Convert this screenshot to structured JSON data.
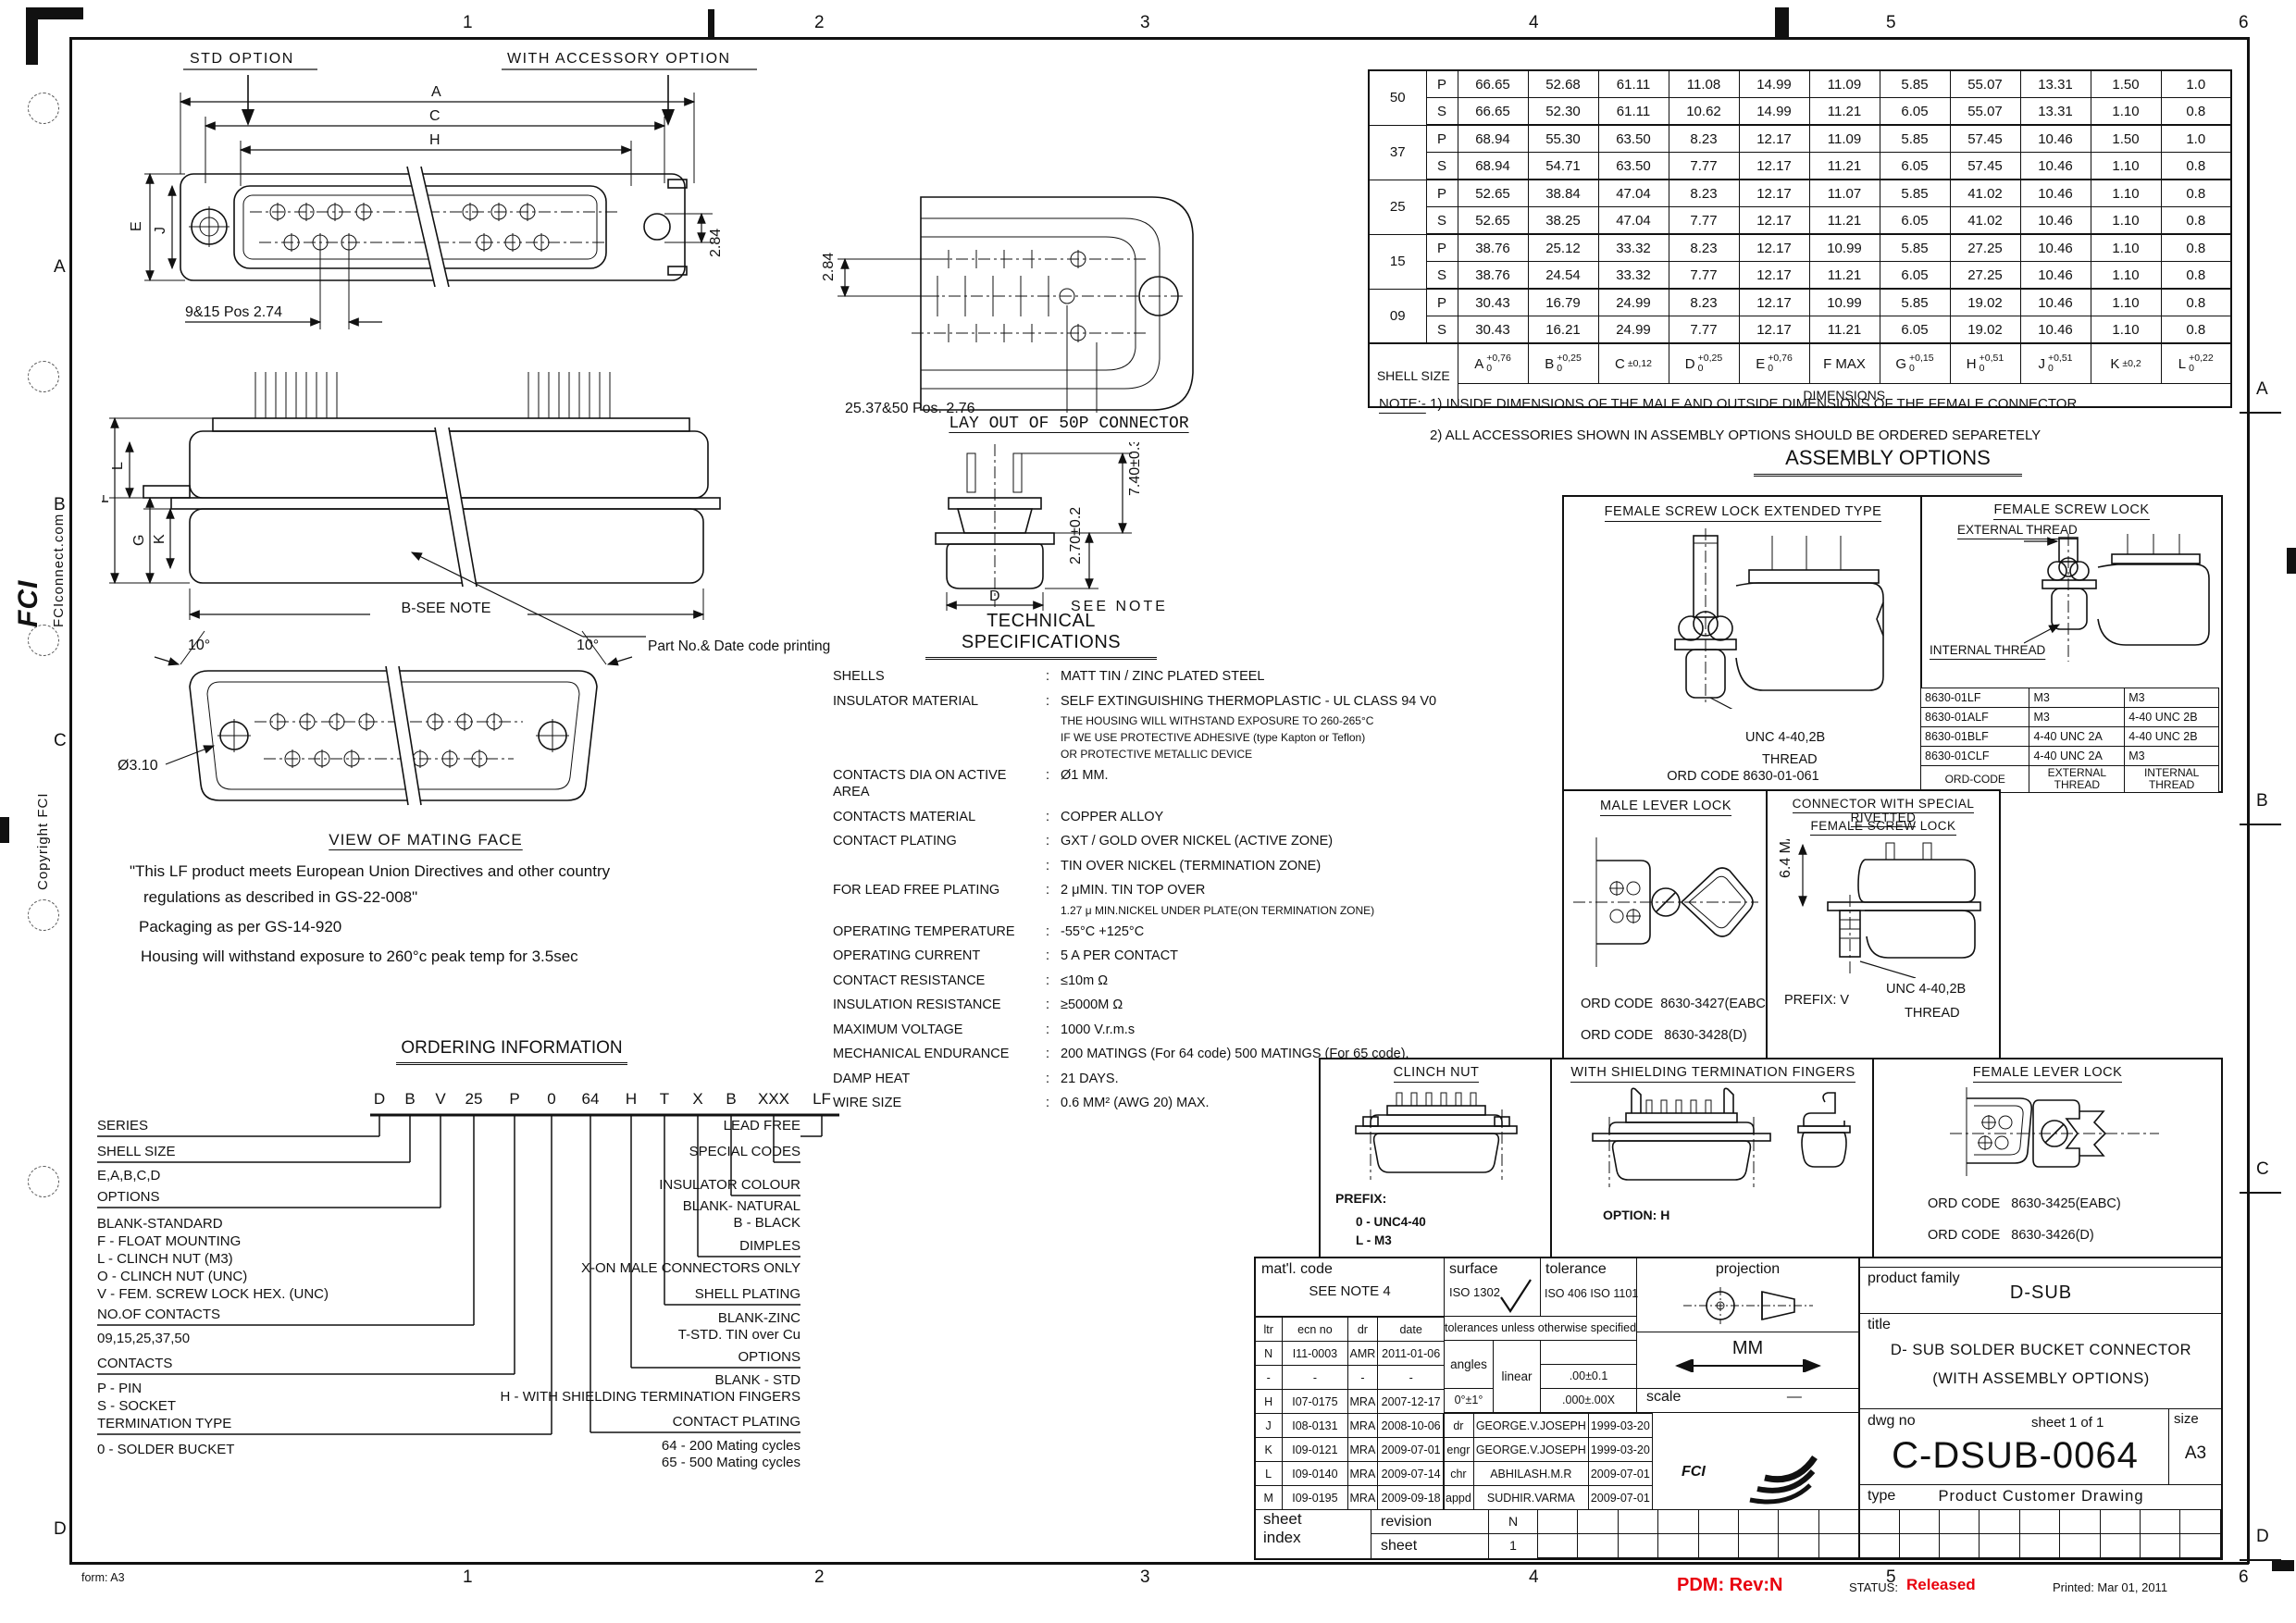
{
  "page": {
    "zones_h": [
      "1",
      "2",
      "3",
      "4",
      "5",
      "6"
    ],
    "zones_v": [
      "A",
      "B",
      "C",
      "D"
    ],
    "form": "form: A3",
    "pdm": "PDM: Rev:N",
    "status_label": "STATUS:",
    "status_value": "Released",
    "printed": "Printed: Mar 01, 2011",
    "site": "FCIconnect.com",
    "copyright": "Copyright FCI",
    "logo": "FCI",
    "accent_red": "#e8000d"
  },
  "dim_table": {
    "shell_size_label": "SHELL SIZE",
    "dimensions_label": "DIMENSIONS",
    "cols": [
      {
        "l": "A",
        "t": "+0,76",
        "b": "0"
      },
      {
        "l": "B",
        "t": "+0,25",
        "b": "0"
      },
      {
        "l": "C",
        "t": "±0,12",
        "b": ""
      },
      {
        "l": "D",
        "t": "+0,25",
        "b": "0"
      },
      {
        "l": "E",
        "t": "+0,76",
        "b": "0"
      },
      {
        "l": "F MAX",
        "t": "",
        "b": ""
      },
      {
        "l": "G",
        "t": "+0,15",
        "b": "0"
      },
      {
        "l": "H",
        "t": "+0,51",
        "b": "0"
      },
      {
        "l": "J",
        "t": "+0,51",
        "b": "0"
      },
      {
        "l": "K",
        "t": "±0,2",
        "b": ""
      },
      {
        "l": "L",
        "t": "+0,22",
        "b": "0"
      }
    ],
    "rows": [
      [
        {
          "t": "50",
          "rs": 2
        },
        "P",
        "66.65",
        "52.68",
        "61.11",
        "11.08",
        "14.99",
        "11.09",
        "5.85",
        "55.07",
        "13.31",
        "1.50",
        "1.0"
      ],
      [
        "S",
        "66.65",
        "52.30",
        "61.11",
        "10.62",
        "14.99",
        "11.21",
        "6.05",
        "55.07",
        "13.31",
        "1.10",
        "0.8"
      ],
      [
        {
          "t": "37",
          "rs": 2
        },
        "P",
        "68.94",
        "55.30",
        "63.50",
        "8.23",
        "12.17",
        "11.09",
        "5.85",
        "57.45",
        "10.46",
        "1.50",
        "1.0"
      ],
      [
        "S",
        "68.94",
        "54.71",
        "63.50",
        "7.77",
        "12.17",
        "11.21",
        "6.05",
        "57.45",
        "10.46",
        "1.10",
        "0.8"
      ],
      [
        {
          "t": "25",
          "rs": 2
        },
        "P",
        "52.65",
        "38.84",
        "47.04",
        "8.23",
        "12.17",
        "11.07",
        "5.85",
        "41.02",
        "10.46",
        "1.10",
        "0.8"
      ],
      [
        "S",
        "52.65",
        "38.25",
        "47.04",
        "7.77",
        "12.17",
        "11.21",
        "6.05",
        "41.02",
        "10.46",
        "1.10",
        "0.8"
      ],
      [
        {
          "t": "15",
          "rs": 2
        },
        "P",
        "38.76",
        "25.12",
        "33.32",
        "8.23",
        "12.17",
        "10.99",
        "5.85",
        "27.25",
        "10.46",
        "1.10",
        "0.8"
      ],
      [
        "S",
        "38.76",
        "24.54",
        "33.32",
        "7.77",
        "12.17",
        "11.21",
        "6.05",
        "27.25",
        "10.46",
        "1.10",
        "0.8"
      ],
      [
        {
          "t": "09",
          "rs": 2
        },
        "P",
        "30.43",
        "16.79",
        "24.99",
        "8.23",
        "12.17",
        "10.99",
        "5.85",
        "19.02",
        "10.46",
        "1.10",
        "0.8"
      ],
      [
        "S",
        "30.43",
        "16.21",
        "24.99",
        "7.77",
        "12.17",
        "11.21",
        "6.05",
        "19.02",
        "10.46",
        "1.10",
        "0.8"
      ]
    ]
  },
  "notes": {
    "label": "NOTE:-",
    "n1": "1)  INSIDE  DIMENSIONS  OF  THE  MALE  AND  OUTSIDE  DIMENSIONS  OF  THE  FEMALE  CONNECTOR",
    "n2": "2)  ALL  ACCESSORIES  SHOWN  IN  ASSEMBLY  OPTIONS  SHOULD  BE  ORDERED  SEPARETELY"
  },
  "assembly": {
    "title": "ASSEMBLY OPTIONS",
    "fsl_ext": {
      "title": "FEMALE SCREW LOCK EXTENDED TYPE",
      "thread1": "UNC 4-40,2B",
      "thread2": "THREAD",
      "ord": "ORD CODE 8630-01-061"
    },
    "fsl": {
      "title": "FEMALE SCREW LOCK",
      "ext": "EXTERNAL THREAD",
      "int": "INTERNAL THREAD",
      "table": [
        [
          "8630-01LF",
          "M3",
          "M3"
        ],
        [
          "8630-01ALF",
          "M3",
          "4-40 UNC 2B"
        ],
        [
          "8630-01BLF",
          "4-40 UNC 2A",
          "4-40 UNC 2B"
        ],
        [
          "8630-01CLF",
          "4-40 UNC 2A",
          "M3"
        ],
        [
          "ORD-CODE",
          "EXTERNAL THREAD",
          "INTERNAL THREAD"
        ]
      ]
    },
    "mll": {
      "title": "MALE LEVER LOCK",
      "ord_label": "ORD CODE",
      "ord1": "8630-3427(EABC)",
      "ord2": "8630-3428(D)"
    },
    "riv": {
      "title1": "CONNECTOR WITH SPECIAL RIVETTED",
      "title2": "FEMALE SCREW LOCK",
      "dim": "6.4 MAX",
      "prefix": "PREFIX: V",
      "thread1": "UNC 4-40,2B",
      "thread2": "THREAD"
    },
    "clinch": {
      "title": "CLINCH NUT",
      "prefix": "PREFIX:",
      "p1": "0 - UNC4-40",
      "p2": "L - M3"
    },
    "shield": {
      "title": "WITH SHIELDING TERMINATION FINGERS",
      "option": "OPTION: H"
    },
    "fll": {
      "title": "FEMALE LEVER LOCK",
      "ord_label": "ORD CODE",
      "ord1": "8630-3425(EABC)",
      "ord2": "8630-3426(D)"
    }
  },
  "tech_specs": {
    "title": "TECHNICAL SPECIFICATIONS",
    "rows": [
      {
        "label": "SHELLS",
        "value": "MATT TIN  / ZINC PLATED STEEL",
        "sub": []
      },
      {
        "label": "INSULATOR MATERIAL",
        "value": "SELF EXTINGUISHING THERMOPLASTIC - UL CLASS 94 V0",
        "sub": [
          "THE HOUSING WILL WITHSTAND EXPOSURE TO 260-265°C",
          "IF WE USE PROTECTIVE ADHESIVE (type Kapton or Teflon)",
          "OR PROTECTIVE METALLIC DEVICE"
        ]
      },
      {
        "label": "CONTACTS DIA ON ACTIVE AREA",
        "value": "Ø1 MM.",
        "sub": []
      },
      {
        "label": "CONTACTS MATERIAL",
        "value": "COPPER ALLOY",
        "sub": []
      },
      {
        "label": "CONTACT PLATING",
        "value": "GXT / GOLD OVER NICKEL (ACTIVE ZONE)",
        "sub": []
      },
      {
        "label": "",
        "value": "TIN OVER NICKEL (TERMINATION ZONE)",
        "sub": []
      },
      {
        "label": "FOR LEAD FREE PLATING",
        "value": "2 μMIN. TIN TOP OVER",
        "sub": [
          "1.27 μ MIN.NICKEL UNDER PLATE(ON TERMINATION ZONE)"
        ]
      },
      {
        "label": "OPERATING TEMPERATURE",
        "value": "-55°C +125°C",
        "sub": []
      },
      {
        "label": "OPERATING CURRENT",
        "value": "5 A PER CONTACT",
        "sub": []
      },
      {
        "label": "CONTACT RESISTANCE",
        "value": "≤10m  Ω",
        "sub": []
      },
      {
        "label": "INSULATION RESISTANCE",
        "value": "≥5000M  Ω",
        "sub": []
      },
      {
        "label": "MAXIMUM VOLTAGE",
        "value": "1000 V.r.m.s",
        "sub": []
      },
      {
        "label": "MECHANICAL ENDURANCE",
        "value": "200 MATINGS (For 64 code) 500 MATINGS (For 65 code).",
        "sub": []
      },
      {
        "label": "DAMP HEAT",
        "value": "21 DAYS.",
        "sub": []
      },
      {
        "label": "WIRE SIZE",
        "value": "0.6 MM² (AWG 20) MAX.",
        "sub": []
      }
    ]
  },
  "ordering": {
    "title": "ORDERING INFORMATION",
    "code": [
      "D",
      "B",
      "V",
      "25",
      "P",
      "0",
      "64",
      "H",
      "T",
      "X",
      "B",
      "XXX",
      "LF"
    ],
    "left": {
      "series": "SERIES",
      "shell_size": "SHELL SIZE",
      "shell_sizes": "E,A,B,C,D",
      "options": "OPTIONS",
      "opt1": "BLANK-STANDARD",
      "opt2": "F - FLOAT MOUNTING",
      "opt3": "L - CLINCH NUT (M3)",
      "opt4": "O - CLINCH NUT (UNC)",
      "opt5": "V - FEM. SCREW LOCK HEX. (UNC)",
      "contacts_no": "NO.OF CONTACTS",
      "contacts_no_values": "09,15,25,37,50",
      "contacts": "CONTACTS",
      "c1": "P - PIN",
      "c2": "S - SOCKET",
      "termination": "TERMINATION TYPE",
      "t1": "0  - SOLDER BUCKET"
    },
    "right": {
      "lead_free": "LEAD FREE",
      "special": "SPECIAL CODES",
      "colour": "INSULATOR COLOUR",
      "col1": "BLANK- NATURAL",
      "col2": "B - BLACK",
      "dimples": "DIMPLES",
      "dim1": "X-ON MALE CONNECTORS ONLY",
      "shell_plating": "SHELL PLATING",
      "sp1": "BLANK-ZINC",
      "sp2": "T-STD. TIN over Cu",
      "options": "OPTIONS",
      "o1": "BLANK - STD",
      "o2": "H - WITH SHIELDING TERMINATION FINGERS",
      "contact_plating": "CONTACT PLATING",
      "cp1": "64 - 200 Mating cycles",
      "cp2": "65 - 500 Mating cycles"
    }
  },
  "drawings": {
    "front": {
      "std": "STD OPTION",
      "acc": "WITH ACCESSORY OPTION",
      "a": "A",
      "c": "C",
      "h": "H",
      "e": "E",
      "j": "J",
      "pos": "9&15 Pos 2.74",
      "d284": "2.84"
    },
    "side": {
      "l": "L",
      "f": "F",
      "g": "G",
      "k": "K",
      "b": "B-SEE NOTE",
      "part": "Part No.& Date code printing"
    },
    "mating": {
      "caption": "VIEW OF MATING FACE",
      "dia": "Ø3.10",
      "ang": "10°"
    },
    "layout50": {
      "d284": "2.84",
      "pos": "25,37&50 Pos. 2,76",
      "caption": "LAY OUT OF 50P CONNECTOR"
    },
    "profile50": {
      "d740": "7.40±0.3",
      "d270": "2.70±0.2",
      "d": "D",
      "see": "SEE NOTE"
    },
    "lf": {
      "l1": "\"This LF product meets European Union Directives and other country",
      "l2": "regulations as described in GS-22-008\"",
      "l3": "Packaging as per GS-14-920",
      "l4": "Housing will withstand exposure to 260°c peak temp for 3.5sec"
    }
  },
  "title_block": {
    "matl_label": "mat'l. code",
    "matl_value": "SEE NOTE 4",
    "surface_label": "surface",
    "surface_value": "ISO 1302",
    "tol_label": "tolerance",
    "tol_value": "ISO 406 ISO 1101",
    "proj_label": "projection",
    "tol_note": "tolerances unless otherwise specified",
    "rev_table": [
      [
        "ltr",
        "ecn no",
        "dr",
        "date"
      ],
      [
        "N",
        "I11-0003",
        "AMR",
        "2011-01-06"
      ],
      [
        "-",
        "-",
        "-",
        "-"
      ],
      [
        "H",
        "I07-0175",
        "MRA",
        "2007-12-17"
      ],
      [
        "J",
        "I08-0131",
        "MRA",
        "2008-10-06"
      ],
      [
        "K",
        "I09-0121",
        "MRA",
        "2009-07-01"
      ],
      [
        "L",
        "I09-0140",
        "MRA",
        "2009-07-14"
      ],
      [
        "M",
        "I09-0195",
        "MRA",
        "2009-09-18"
      ]
    ],
    "angles_label": "angles",
    "linear_label": "linear",
    "lin_tol": ".00±0.1",
    "ang_tol": "0°±1°",
    "lin_tol2": ".000±.00X",
    "units": "MM",
    "scale_label": "scale",
    "scale_value": "—",
    "signoff": [
      [
        "dr",
        "GEORGE.V.JOSEPH",
        "1999-03-20"
      ],
      [
        "engr",
        "GEORGE.V.JOSEPH",
        "1999-03-20"
      ],
      [
        "chr",
        "ABHILASH.M.R",
        "2009-07-01"
      ],
      [
        "appd",
        "SUDHIR.VARMA",
        "2009-07-01"
      ]
    ],
    "sheet_word": "sheet",
    "index_word": "index",
    "revision_label": "revision",
    "revision_value": "N",
    "sheet_label": "sheet",
    "sheet_value": "1",
    "pf_label": "product family",
    "pf_value": "D-SUB",
    "title_label": "title",
    "title1": "D- SUB SOLDER BUCKET CONNECTOR",
    "title2": "(WITH ASSEMBLY OPTIONS)",
    "dwg_label": "dwg no",
    "sheet_of": "sheet 1  of  1",
    "dwg_no": "C-DSUB-0064",
    "size_label": "size",
    "size_value": "A3",
    "type_label": "type",
    "type_value": "Product  Customer   Drawing",
    "logo_text": "FCI"
  }
}
